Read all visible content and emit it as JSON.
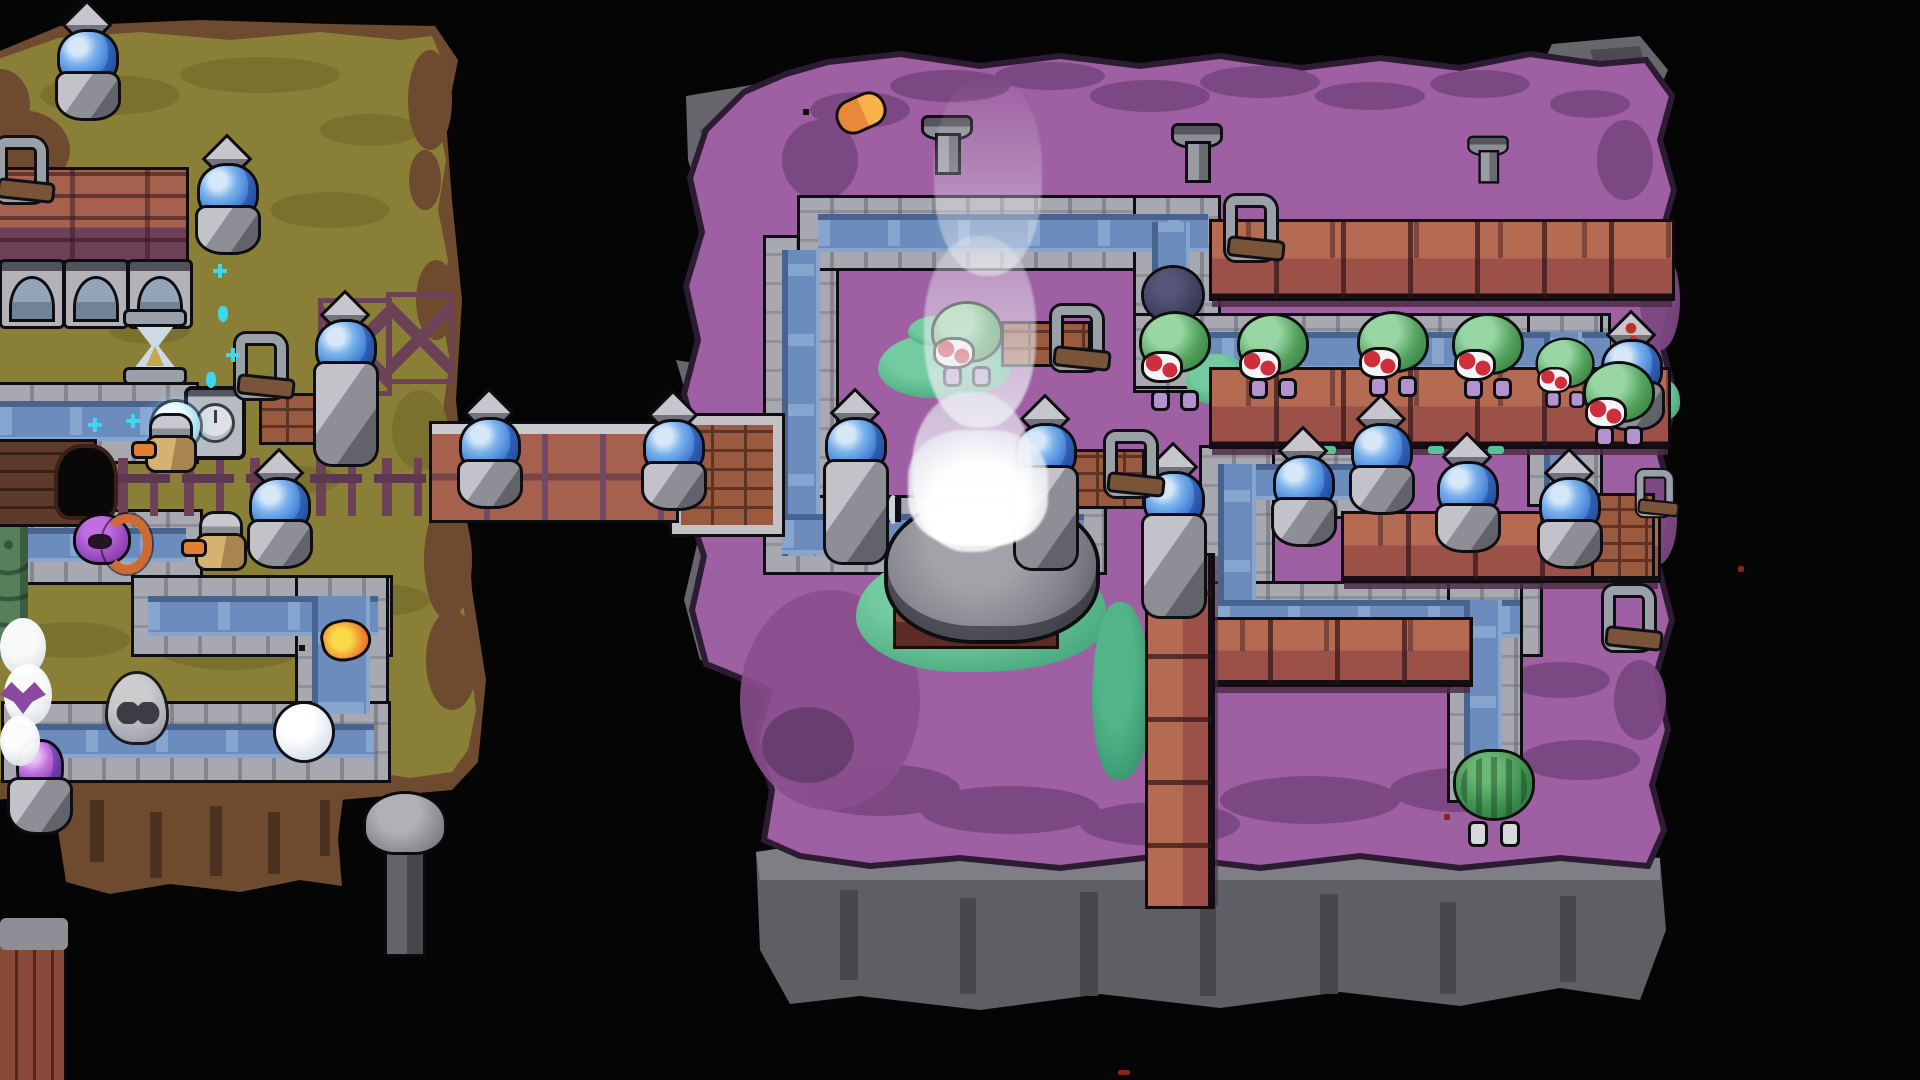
{
  "scene": {
    "width": 1920,
    "height": 1080,
    "background": "#050505"
  },
  "palette": {
    "void": "#050505",
    "left_island_ground": "#8a7f37",
    "left_island_shade": "#79702e",
    "dirt_edge": "#6e4a2f",
    "right_island_ground": "#9e60a3",
    "right_island_shade": "#7b4783",
    "rock_gray": "#66666c",
    "cliff_gray": "#5e5e64",
    "canal_stone": "#a8a8b0",
    "canal_water": "#6b8cbd",
    "water_highlight": "#8fb0d8",
    "wood_top": "#b56a52",
    "wood_side": "#9c5148",
    "wood_shadow": "#5d3553",
    "crystal_blue": "#3f7cd4",
    "crystal_highlight": "#7ab2ec",
    "gem_purple": "#9240bc",
    "enemy_green": "#55a35e",
    "berry_red": "#cf2f3c",
    "enemy_legs_lilac": "#b393cf",
    "grass_teal": "#4fae83",
    "flame_orange": "#f09030",
    "flame_yellow": "#f9d84a",
    "steam_white": "#eef0f5",
    "ghost_gray": "#a9a9b0",
    "sparkle_cyan": "#3cd8f0"
  },
  "sprites": {
    "crystal": [
      {
        "x": 56,
        "y": 10
      },
      {
        "x": 196,
        "y": 144
      },
      {
        "x": 314,
        "y": 300,
        "v": "tall"
      },
      {
        "x": 248,
        "y": 458
      },
      {
        "x": 458,
        "y": 398
      },
      {
        "x": 642,
        "y": 400
      },
      {
        "x": 824,
        "y": 398,
        "v": "tall"
      },
      {
        "x": 1014,
        "y": 404,
        "v": "tall"
      },
      {
        "x": 1142,
        "y": 452,
        "v": "tall"
      },
      {
        "x": 1272,
        "y": 436
      },
      {
        "x": 1350,
        "y": 404
      },
      {
        "x": 1436,
        "y": 442
      },
      {
        "x": 1538,
        "y": 458
      },
      {
        "x": 1600,
        "y": 320,
        "v": "marked"
      },
      {
        "x": 8,
        "y": 720,
        "v": "purple",
        "n": "purple-crystal-tower"
      }
    ],
    "enemy": [
      {
        "x": 934,
        "y": 304
      },
      {
        "x": 1142,
        "y": 268,
        "v": "carrier",
        "h": 140,
        "n": "sprout-creature-carrier"
      },
      {
        "x": 1240,
        "y": 316
      },
      {
        "x": 1360,
        "y": 314
      },
      {
        "x": 1455,
        "y": 316
      },
      {
        "x": 1538,
        "y": 340,
        "v": "small"
      },
      {
        "x": 1586,
        "y": 364
      }
    ],
    "willow": [
      {
        "x": 1456,
        "y": 752
      }
    ],
    "lever": [
      {
        "x": -8,
        "y": 138
      },
      {
        "x": 232,
        "y": 334
      },
      {
        "x": 1222,
        "y": 196
      },
      {
        "x": 1048,
        "y": 306
      },
      {
        "x": 1102,
        "y": 432
      },
      {
        "x": 1600,
        "y": 586
      },
      {
        "x": 1634,
        "y": 470,
        "v": "small"
      }
    ],
    "brazier": [
      {
        "x": 922,
        "y": 118
      },
      {
        "x": 1172,
        "y": 126
      },
      {
        "x": 1468,
        "y": 138,
        "v": "small"
      }
    ],
    "machine": [
      {
        "x": 2,
        "y": 262
      },
      {
        "x": 66,
        "y": 262
      },
      {
        "x": 130,
        "y": 262
      }
    ],
    "hourglass": [
      {
        "x": 124,
        "y": 312
      }
    ],
    "clock": [
      {
        "x": 188,
        "y": 390
      }
    ],
    "ghost": [
      {
        "x": 106,
        "y": 674
      }
    ],
    "orb": [
      {
        "x": 276,
        "y": 704,
        "n": "white-orb"
      },
      {
        "x": 152,
        "y": 402,
        "v": "cyan",
        "w": 48,
        "h": 48,
        "n": "water-orb"
      }
    ],
    "hood": [
      {
        "x": 76,
        "y": 512
      }
    ],
    "knight": [
      {
        "x": 142,
        "y": 416
      },
      {
        "x": 192,
        "y": 514
      }
    ],
    "crate": [
      {
        "x": 1004,
        "y": 324,
        "w": 84,
        "h": 40,
        "n": "wood-sign"
      },
      {
        "x": 1072,
        "y": 452,
        "w": 70,
        "h": 54,
        "n": "wood-crate"
      },
      {
        "x": 262,
        "y": 396,
        "w": 52,
        "h": 46,
        "n": "wood-sign"
      },
      {
        "x": 1594,
        "y": 496,
        "w": 58,
        "h": 80,
        "n": "wood-platform"
      }
    ],
    "mushroom": [
      {
        "x": 366,
        "y": 794
      }
    ],
    "fence": [
      {
        "x": 118,
        "y": 458,
        "w": 336,
        "h": 58
      }
    ],
    "fencex": [
      {
        "x": 318,
        "y": 298,
        "w": 64,
        "h": 88
      },
      {
        "x": 386,
        "y": 292,
        "w": 58,
        "h": 82
      }
    ],
    "grass": [
      {
        "x": 878,
        "y": 334,
        "w": 132,
        "h": 64
      },
      {
        "x": 856,
        "y": 550,
        "w": 250,
        "h": 122
      },
      {
        "x": 1092,
        "y": 602,
        "w": 58,
        "h": 178,
        "v": "dk"
      },
      {
        "x": 908,
        "y": 316,
        "w": 64,
        "h": 30
      },
      {
        "x": 1186,
        "y": 354,
        "w": 62,
        "h": 50
      },
      {
        "x": 1638,
        "y": 378,
        "w": 42,
        "h": 44
      },
      {
        "x": 926,
        "y": 536,
        "w": 40,
        "h": 22,
        "v": "dk"
      }
    ],
    "dash": [
      {
        "x": 1320,
        "y": 446
      },
      {
        "x": 1368,
        "y": 446
      },
      {
        "x": 1428,
        "y": 446
      },
      {
        "x": 1488,
        "y": 446
      }
    ],
    "sparkle": [
      {
        "x": 213,
        "y": 264
      },
      {
        "x": 218,
        "y": 306,
        "v": "drop"
      },
      {
        "x": 226,
        "y": 348
      },
      {
        "x": 206,
        "y": 372,
        "v": "drop"
      },
      {
        "x": 88,
        "y": 418
      },
      {
        "x": 126,
        "y": 414
      }
    ],
    "smokepuff": [
      {
        "x": 0,
        "y": 618,
        "w": 46,
        "h": 58
      },
      {
        "x": 4,
        "y": 664,
        "w": 48,
        "h": 62
      },
      {
        "x": 0,
        "y": 716,
        "w": 40,
        "h": 50
      }
    ],
    "bat": [
      {
        "x": 0,
        "y": 682
      }
    ],
    "mossstrip": [
      {
        "x": 0,
        "y": 516,
        "w": 28,
        "h": 144
      }
    ],
    "planks": [
      {
        "x": 0,
        "y": 926,
        "w": 64,
        "h": 154
      }
    ],
    "rect": [
      {
        "x": 0,
        "y": 918,
        "w": 68,
        "h": 32,
        "bg": "#8e8e96",
        "br": "6px",
        "n": "stone-cap"
      }
    ],
    "dock": [
      {
        "x": 0,
        "y": 442,
        "w": 94,
        "h": 82
      }
    ],
    "hole": [
      {
        "x": 58,
        "y": 448,
        "w": 56,
        "h": 68
      }
    ],
    "flameitem": [
      {
        "x": 324,
        "y": 622
      }
    ],
    "capsule": [
      {
        "x": 838,
        "y": 98
      }
    ],
    "speck": [
      {
        "x": 1444,
        "y": 814
      },
      {
        "x": 1738,
        "y": 566
      },
      {
        "x": 1118,
        "y": 1070,
        "w": 12,
        "h": 5
      }
    ]
  }
}
